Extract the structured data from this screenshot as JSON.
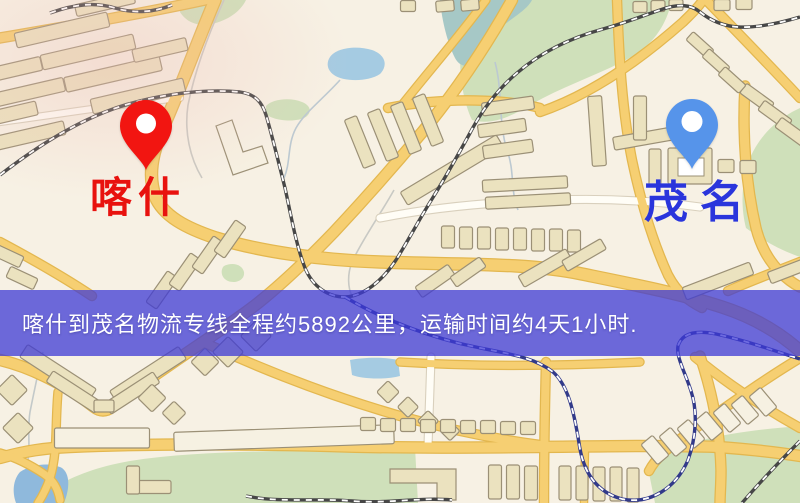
{
  "map": {
    "origin": {
      "name": "喀什",
      "marker_color": "#f21511",
      "label_color": "#e8120e"
    },
    "destination": {
      "name": "茂名",
      "marker_color": "#5694ea",
      "label_color": "#2a35dc"
    },
    "banner": {
      "text": "喀什到茂名物流专线全程约5892公里，运输时间约4天1小时.",
      "bg_color": "rgba(62,58,214,0.75)",
      "text_color": "#ffffff"
    },
    "colors": {
      "background": "#f7f1e4",
      "road_fill": "#f6cf72",
      "road_casing": "#e3b74f",
      "white_road_fill": "#fffdf6",
      "white_road_casing": "#d9d0bd",
      "building_fill": "#ebe2bf",
      "building_light_fill": "#f6f1e2",
      "building_stroke": "#9b9076",
      "park": "#cfe0ba",
      "water": "#a5cbe2",
      "river": "#a6c8c6",
      "railway": "#474747",
      "metro": "#323a8a"
    }
  }
}
